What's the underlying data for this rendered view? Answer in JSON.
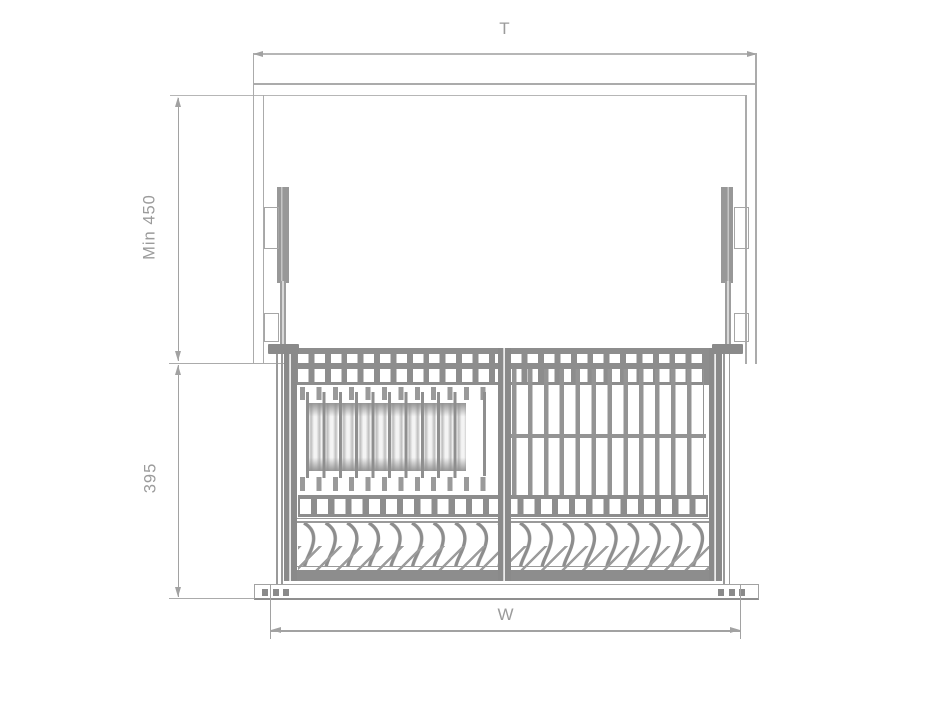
{
  "drawing": {
    "dimensions": {
      "top": {
        "label": "T"
      },
      "upper_height": {
        "label": "Min 450"
      },
      "lower_height": {
        "label": "395"
      },
      "bottom": {
        "label": "W"
      }
    },
    "colors": {
      "background": "#ffffff",
      "outline_line": "#ababab",
      "dimension_line": "#a2a2a2",
      "rack_dark": "#8d8d8d",
      "label_text": "#9b9b9b"
    }
  }
}
